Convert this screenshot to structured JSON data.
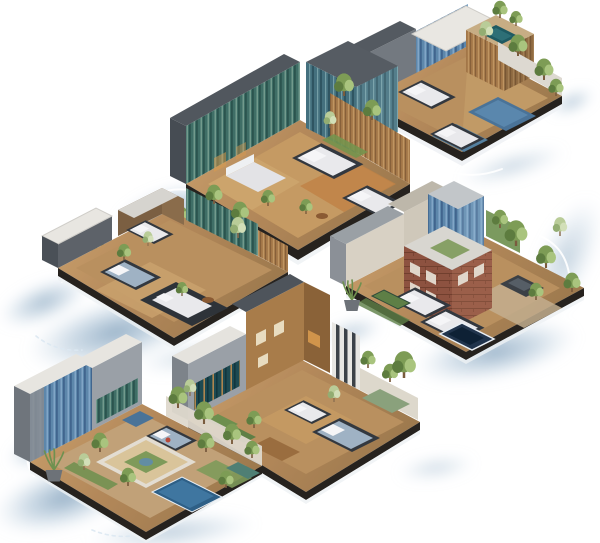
{
  "meta": {
    "title": "Isometric architecture renders",
    "description": "Six isometric cutaway renderings of modern houses with bedrooms, pools, wooden decks and trees, floating on a white background over soft blue water shadows"
  },
  "palette": {
    "background": "#ffffff",
    "water_core": "#7b9cb8",
    "water_mid": "#9db8cf",
    "deck_wood": "#b3885a",
    "deck_light": "#c9a26c",
    "plot_fascia": "#26221e",
    "wall_dark": "#51575e",
    "wall_mid": "#9aa0a7",
    "wall_light": "#d8d6d0",
    "roof_white": "#e8e6e1",
    "glass_teal": "#3f6e66",
    "glass_blue": "#5d87ab",
    "glass_tower": "#44707e",
    "brick": "#8d5240",
    "slat_wood": "#a87c4c",
    "interior_warm": "#bf8347",
    "bed_white": "#e9e9ec",
    "bed_blue": "#9fb2c4",
    "bed_frame": "#33383f",
    "tree_green": "#7d9c55",
    "tree_dark": "#5d7c3f",
    "tree_light": "#a9c47e",
    "pool_steel": "#4a7398",
    "pool_teal": "#1e5a62",
    "pool_navy": "#21344c",
    "pot_gray": "#6d7278",
    "arc_white": "#ffffff"
  },
  "buildings": [
    {
      "id": "villa-top-right",
      "position": "top-right",
      "label": "Split-level villa with rooftop spa and twin plunge pools"
    },
    {
      "id": "glass-residence-top-center",
      "position": "top-center",
      "label": "Glass-fronted residence with central atrium tower and garden island"
    },
    {
      "id": "courtyard-house-middle-left",
      "position": "middle-left",
      "label": "Low-rise courtyard home with open-air bedrooms"
    },
    {
      "id": "brick-complex-middle-right",
      "position": "middle-right",
      "label": "Brick and glass residence with tree-lined drive and spa"
    },
    {
      "id": "timber-house-bottom-center",
      "position": "bottom-center",
      "label": "Timber townhouse with striped accent wall"
    },
    {
      "id": "garden-villa-bottom-left",
      "position": "bottom-left",
      "label": "Garden villa with parterre courtyard and lap pool"
    }
  ]
}
